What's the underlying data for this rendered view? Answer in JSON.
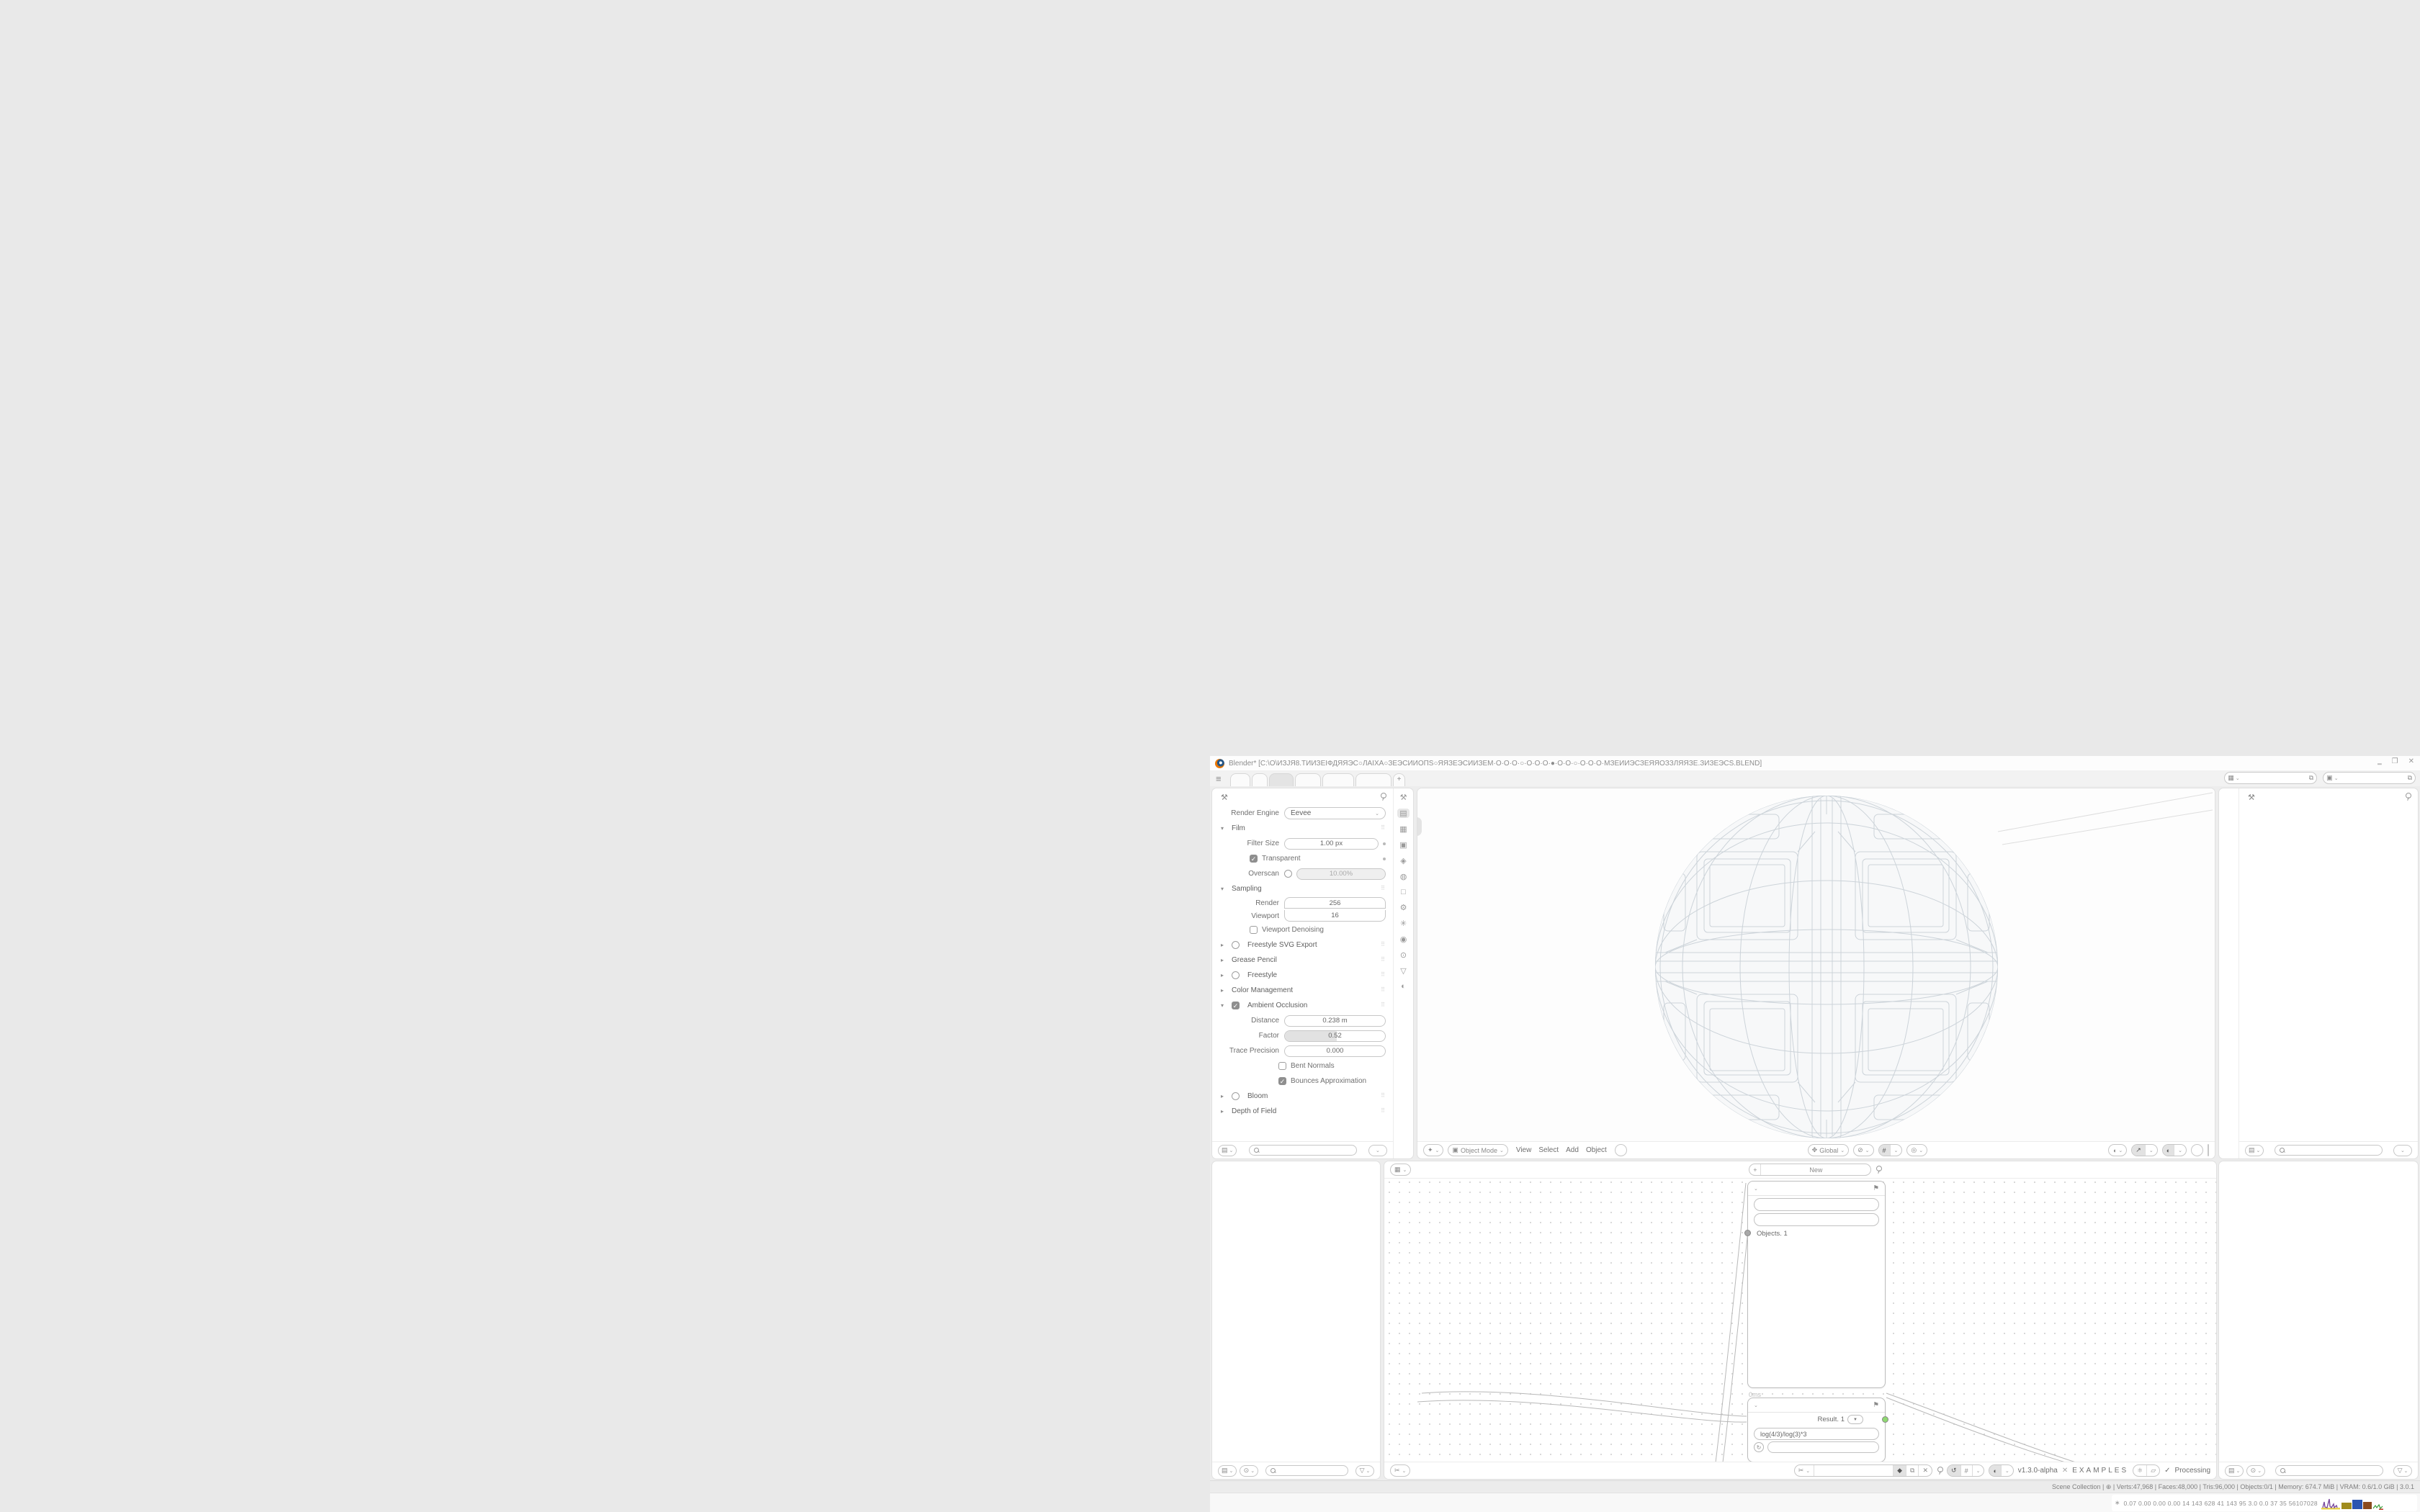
{
  "window": {
    "title": "Blender* [C:\\O\\ИЗЈЯ8.ТИИЗЕІФДЯЯЭС○ЛАІХА○ЗЕЭСИИОПЅ○ЯЯЗЕЭСИИЗЕМ·О·О·О·○·О·О·О·●·О·О·○·О·О·О·МЗЕИИЭСЗЕЯЯОЗЗЛЯЯЗЕ.ЗИЗЕЭСЅ.BLEND]",
    "minimize": "‗",
    "restore": "❐",
    "close": "✕"
  },
  "tabsbar": {
    "menu_icon": "≡",
    "tabs": [
      "",
      "",
      "",
      "",
      "",
      ""
    ],
    "active_index": 2,
    "tab_widths": [
      28,
      22,
      34,
      36,
      44,
      50
    ],
    "new_tab": "+",
    "scene_field": "",
    "viewlayer_field": "",
    "field_icons": [
      "▦",
      "▣"
    ],
    "copy_icon": "⧉"
  },
  "props": {
    "tool_icon": "⚒",
    "nav_icons": [
      "⚒",
      "▤",
      "▦",
      "▣",
      "◈",
      "◍",
      "□",
      "⚙",
      "✳",
      "◉",
      "⊙",
      "▽",
      "◐"
    ],
    "nav_active_index": 1,
    "rows": [
      {
        "t": "engine",
        "label": "Render Engine",
        "value": "Eevee"
      },
      {
        "t": "sec",
        "state": "open",
        "label": "Film"
      },
      {
        "t": "field",
        "label": "Filter Size",
        "value": "1.00 px",
        "dot": true
      },
      {
        "t": "check",
        "on": true,
        "label": "Transparent",
        "dot": true
      },
      {
        "t": "overscan",
        "label": "Overscan",
        "value": "10.00%",
        "on": false
      },
      {
        "t": "sec",
        "state": "open",
        "label": "Sampling"
      },
      {
        "t": "dfield",
        "label": "Render",
        "value": "256",
        "pos": "top"
      },
      {
        "t": "dfield",
        "label": "Viewport",
        "value": "16",
        "pos": "bot"
      },
      {
        "t": "check",
        "on": false,
        "label": "Viewport Denoising"
      },
      {
        "t": "sec",
        "state": "closed",
        "toggle": false,
        "label": "Freestyle SVG Export"
      },
      {
        "t": "sec",
        "state": "closed",
        "label": "Grease Pencil"
      },
      {
        "t": "sec",
        "state": "closed",
        "toggle": false,
        "label": "Freestyle"
      },
      {
        "t": "sec",
        "state": "closed",
        "label": "Color Management"
      },
      {
        "t": "sec",
        "state": "open",
        "toggle": true,
        "label": "Ambient Occlusion"
      },
      {
        "t": "field",
        "label": "Distance",
        "value": "0.238 m"
      },
      {
        "t": "slider",
        "label": "Factor",
        "value": "0.52",
        "fill": 52
      },
      {
        "t": "field",
        "label": "Trace Precision",
        "value": "0.000"
      },
      {
        "t": "check",
        "on": false,
        "label": "Bent Normals",
        "ind": 2
      },
      {
        "t": "check",
        "on": true,
        "label": "Bounces Approximation",
        "ind": 2
      },
      {
        "t": "sec",
        "state": "closed",
        "toggle": false,
        "label": "Bloom"
      },
      {
        "t": "sec",
        "state": "closed",
        "label": "Depth of Field"
      }
    ]
  },
  "viewport": {
    "editor_icon": "✦",
    "mode_icon": "▣",
    "mode": "Object Mode",
    "menus": [
      "View",
      "Select",
      "Add",
      "Object"
    ],
    "orient_icon": "✥",
    "orientation": "Global",
    "mid_icons": [
      "⊘",
      "#",
      "◎"
    ],
    "right_icons": [
      "◖",
      "↗",
      "◐"
    ],
    "shading_modes": [
      "⊕",
      "●",
      "◑",
      "◌"
    ],
    "shading_active_index": 1
  },
  "node_editor": {
    "top_editor_icon": "▦",
    "top_menus": [
      "View",
      "Select",
      "Add",
      "Node"
    ],
    "new_button": "New",
    "bottom_editor_icon": "✂",
    "bottom_menus": [
      "View",
      "Select",
      "Add",
      "Node"
    ],
    "tree_field": "",
    "cluster_icons": [
      "◆",
      "⧉",
      "✕"
    ],
    "version": "v1.3.0-alpha",
    "dna_icon": "✕",
    "project": "EXAMPLES",
    "pill_icons": [
      "⚛",
      "▱"
    ],
    "check_icon": "✓",
    "status": "Processing",
    "node1": {
      "header_icon": "⚑",
      "rows": [
        {
          "label": "Vertices",
          "chip": "∘",
          "suffix": ". 1",
          "socket": "orange"
        },
        {
          "label": "Edges",
          "chip": "▽",
          "suffix": ". 1",
          "socket": "green"
        },
        {
          "label": "Polygons",
          "chip": "◇",
          "suffix": ". 1",
          "socket": "green"
        },
        {
          "label": "Vertex Normals",
          "socket": "orange"
        },
        {
          "label": "Material Idx",
          "socket": "green"
        },
        {
          "label": "Polygon Areas",
          "socket": "green"
        },
        {
          "label": "Polygon Centers",
          "socket": "orange"
        },
        {
          "label": "Polygon Normals",
          "socket": "orange"
        },
        {
          "label": "Matrix",
          "socket": "teal"
        },
        {
          "label": "Object",
          "socket": "gray"
        }
      ],
      "toolgroups": [
        [
          "✕",
          "◉"
        ],
        [
          "⊡",
          "∞"
        ],
        [
          "□",
          "⧉",
          "■",
          "▩"
        ]
      ],
      "toolgroup_dark": "■",
      "buttons_row1": [
        "Apply matrix",
        "merge"
      ],
      "buttons_row2": [
        "Post",
        "VeGr"
      ],
      "active_button": "Post",
      "output_label": "Objects. 1",
      "timing": "0ms"
    },
    "node2": {
      "header_icon": "⚑",
      "result_label": "Result. 1",
      "formula": "log(4/3)/log(3)*3",
      "refresh_icon": "↻",
      "steps": [
        "-1",
        "0",
        "+1"
      ],
      "active_step_index": 2
    }
  },
  "outliner": {
    "filter_icon": "◉",
    "display_icon": "▤",
    "person_icon": "⊙",
    "funnel_icon": "▽",
    "rows": [
      {
        "k": "tool"
      },
      {
        "k": "hdr",
        "arrow": "▸",
        "icon": "▣",
        "label": "View Layers",
        "button": true
      },
      {
        "k": "solo",
        "icon": "◍"
      },
      {
        "k": "hdr",
        "arrow": "",
        "icon": "▦",
        "label": "Scene Collection"
      },
      {
        "k": "hdr",
        "arrow": "▾",
        "icon": "▦",
        "label": "Objects"
      },
      {
        "k": "obj",
        "icon": "▽",
        "name": "8ІЭСЗЕЛОНАЗЕЯЯПТХЗЕТОТЗЕХТІЅ"
      },
      {
        "k": "obj",
        "icon": "▽",
        "name": "8ІЭСЗЕЛОНАЗЕЯЯПТХЗЕТОТЗЕХТІЅ"
      },
      {
        "k": "obj",
        "icon": "▽",
        "name": "8ІЭСЗЕЛОНӨНОЛЗЕЭСІ8",
        "minis": [
          "▽"
        ]
      },
      {
        "k": "obj",
        "icon": "▽",
        "name": "О",
        "minis": [
          "↪",
          "⚙",
          "▽"
        ],
        "eye": true
      },
      {
        "k": "obj",
        "icon": "⊜",
        "name": "О___АЯЯЗЕМАЭС___О___ЭСАМЗІ"
      },
      {
        "k": "obj",
        "icon": "⊜",
        "name": "О_АЯЯЗЕМАЭССАМАЯЯАИНАП_О"
      },
      {
        "k": "obj",
        "icon": "⊜",
        "name": "О_АЯЯЗЕМАЭСОНТЯЯО_О_ОЯЯТН"
      },
      {
        "k": "obj",
        "icon": "▽",
        "name": "ЗЕЯЯЗЕНПZЅАЗЕЯЯПТХЗЕТОТЗЕХТІ"
      },
      {
        "k": "obj",
        "icon": "▽",
        "name": "",
        "minis": [
          "◎",
          "⚙",
          "▽"
        ]
      },
      {
        "k": "obj",
        "icon": "⊥",
        "name": "",
        "minis": [
          "○"
        ],
        "noarrow": true
      },
      {
        "k": "obj",
        "icon": "▽",
        "name": "",
        "minis": [
          "◉",
          "▽"
        ],
        "eye": true
      },
      {
        "k": "obj",
        "icon": "▽",
        "name": "",
        "minis": [
          "◉◉",
          "⚙",
          "▽"
        ],
        "eye": true
      },
      {
        "k": "obj",
        "icon": "▽",
        "name": "",
        "minis": [
          "▣",
          "↪",
          "⚙",
          "▽"
        ],
        "eye": true
      },
      {
        "k": "obj",
        "icon": "⊜",
        "name": "",
        "minis": [
          "◉",
          "↪",
          "⧉"
        ]
      },
      {
        "k": "obj",
        "icon": "▽",
        "name": "",
        "minis": [
          "⊕",
          "↪",
          "⚙",
          "▽"
        ],
        "eye": true,
        "sel": true
      },
      {
        "k": "hdr",
        "arrow": "▸",
        "icon": "↻",
        "label": "Animation",
        "suffix": "⁴²"
      }
    ]
  },
  "statusbar": {
    "hints_left": [
      "Set 3D Cursor",
      "Box Select",
      "Pan View"
    ],
    "hints_mid": [
      "Select",
      "Move"
    ],
    "stats": "Scene Collection | ⊕ | Verts:47,968 | Faces:48,000 | Tris:96,000 | Objects:0/1 | Memory: 674.7 MiB | VRAM: 0.6/1.0 GiB | 3.0.1"
  },
  "taskbar": {
    "apps": [
      {
        "name": "console",
        "color": "#1d5c2e"
      },
      {
        "name": "backup-floppy",
        "color": "#2b55b0"
      },
      {
        "name": "firefox",
        "color": "#e0662e"
      },
      {
        "name": "notepad",
        "color": "#6f9be8"
      },
      {
        "name": "blender",
        "color": "#ea7600"
      },
      {
        "name": "calculator",
        "color": "#3a6fd8"
      },
      {
        "name": "calculator-2",
        "color": "#7fa6e8"
      },
      {
        "name": "inactive-app",
        "color": "#dedede"
      }
    ],
    "perf_icon": "∗",
    "perf_numbers": "0.07 0.00 0.00 0.00   14   143   628   41   143   95   3.0   0.0   37   35   56107028"
  }
}
